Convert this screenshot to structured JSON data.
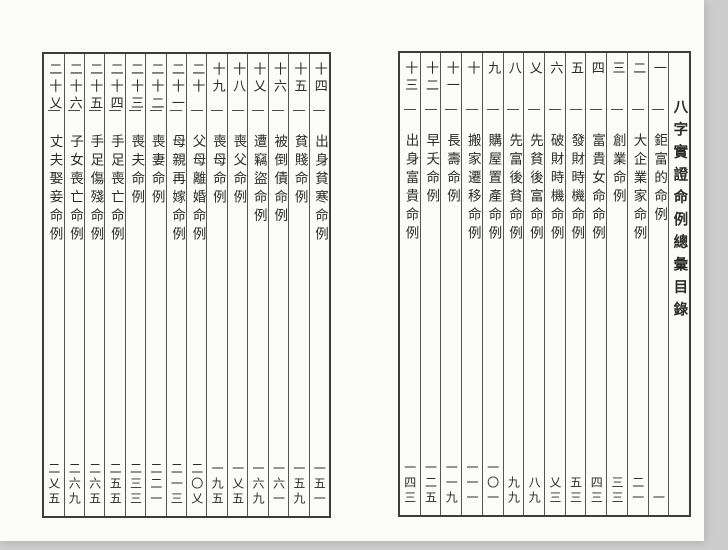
{
  "book": {
    "title": "八字實證命例總彙目錄"
  },
  "ink_color": "#2b2b2b",
  "toc": {
    "right_page_entries": [
      {
        "no": "一",
        "title": "鉅富的命例",
        "page": "一"
      },
      {
        "no": "二",
        "title": "大企業家命例",
        "page": "二一"
      },
      {
        "no": "三",
        "title": "創業命例",
        "page": "三三"
      },
      {
        "no": "四",
        "title": "富貴女命命例",
        "page": "四三"
      },
      {
        "no": "五",
        "title": "發財時機命例",
        "page": "五三"
      },
      {
        "no": "六",
        "title": "破財時機命例",
        "page": "乂三"
      },
      {
        "no": "乂",
        "title": "先貧後富命例",
        "page": "八九"
      },
      {
        "no": "八",
        "title": "先富後貧命例",
        "page": "九九"
      },
      {
        "no": "九",
        "title": "購屋置產命例",
        "page": "一〇一"
      },
      {
        "no": "十",
        "title": "搬家遷移命例",
        "page": "一一一"
      },
      {
        "no": "十一",
        "title": "長壽命例",
        "page": "一一九"
      },
      {
        "no": "十二",
        "title": "早夭命例",
        "page": "一二五"
      },
      {
        "no": "十三",
        "title": "出身富貴命例",
        "page": "一四三"
      }
    ],
    "left_page_entries": [
      {
        "no": "十四",
        "title": "出身貧寒命例",
        "page": "一五一"
      },
      {
        "no": "十五",
        "title": "貧賤命例",
        "page": "一五九"
      },
      {
        "no": "十六",
        "title": "被倒債命例",
        "page": "一六一"
      },
      {
        "no": "十乂",
        "title": "遭竊盜命例",
        "page": "一六九"
      },
      {
        "no": "十八",
        "title": "喪父命例",
        "page": "一乂五"
      },
      {
        "no": "十九",
        "title": "喪母命例",
        "page": "一九五"
      },
      {
        "no": "二十",
        "title": "父母離婚命例",
        "page": "二〇乂"
      },
      {
        "no": "二十一",
        "title": "母親再嫁命例",
        "page": "二一三"
      },
      {
        "no": "二十二",
        "title": "喪妻命例",
        "page": "二二一"
      },
      {
        "no": "二十三",
        "title": "喪夫命例",
        "page": "二三三"
      },
      {
        "no": "二十四",
        "title": "手足喪亡命例",
        "page": "二五五"
      },
      {
        "no": "二十五",
        "title": "手足傷殘命例",
        "page": "二六五"
      },
      {
        "no": "二十六",
        "title": "子女喪亡命例",
        "page": "二六九"
      },
      {
        "no": "二十乂",
        "title": "丈夫娶妾命例",
        "page": "二乂五"
      }
    ]
  }
}
